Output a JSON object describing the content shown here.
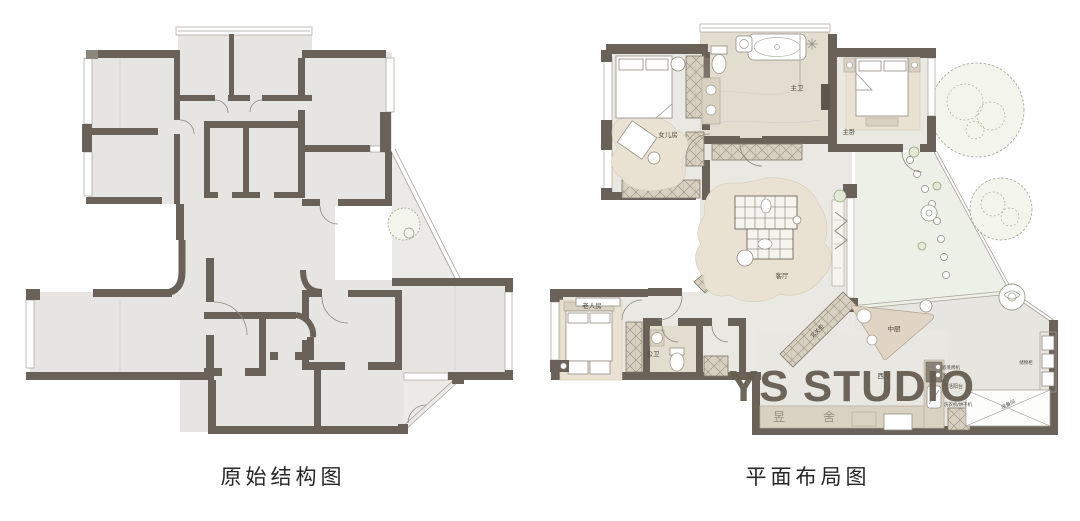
{
  "captions": {
    "left": "原始结构图",
    "right": "平面布局图"
  },
  "watermark": {
    "title": "YS STUDIO",
    "seal_left": "昱",
    "seal_right": "舍"
  },
  "rooms": {
    "daughter_room": "女儿房",
    "master_bath": "主卫",
    "master_bedroom": "主卧",
    "living_room": "客厅",
    "elder_room": "老人房",
    "guest_bath": "公卫",
    "chinese_kitchen": "中厨",
    "western_kitchen": "西厨"
  },
  "annotations": {
    "entry_cabinet": "玄关柜",
    "service_balcony": "生活阳台",
    "washer_dryer": "洗衣机/烘干机",
    "steam_oven_1": "嵌蒸烤机",
    "steam_oven_2": "蒸烤",
    "equipment_area": "设备间",
    "storage_cabinet": "储物柜"
  },
  "colors": {
    "wall": "#6a6258",
    "floor": "#e6e5e1",
    "hatch": "#d8d1c2",
    "plant_green": "#9aa48a",
    "watermark": "#675e52",
    "label_text": "#4f4a42"
  }
}
